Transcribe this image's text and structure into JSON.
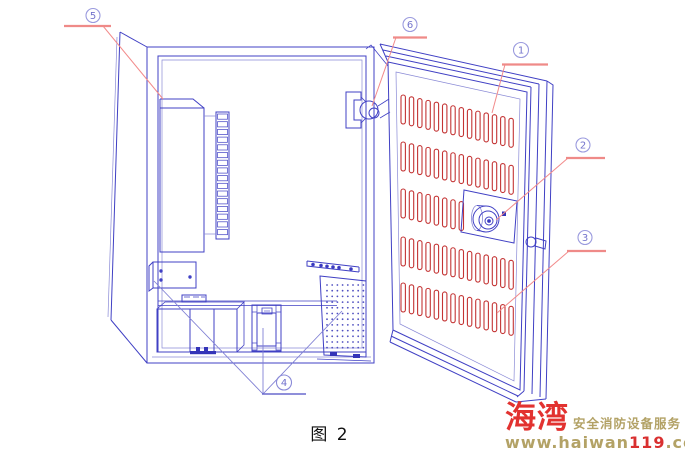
{
  "figure": {
    "caption": "图 2"
  },
  "callouts": {
    "c1": {
      "label": "1"
    },
    "c2": {
      "label": "2"
    },
    "c3": {
      "label": "3"
    },
    "c4": {
      "label": "4"
    },
    "c5": {
      "label": "5"
    },
    "c6": {
      "label": "6"
    }
  },
  "logo": {
    "brand": "海湾",
    "tagline": "安全消防设备服务",
    "url_prefix": "www.haiwan",
    "url_highlight": "119",
    "url_suffix": ".com"
  },
  "colors": {
    "line_blue": "#4040c4",
    "light_blue": "#9a9ade",
    "vent_red": "#c43434",
    "leader_red": "#f28b8b",
    "brand_red": "#e23230",
    "brand_tan": "#b3a266"
  }
}
